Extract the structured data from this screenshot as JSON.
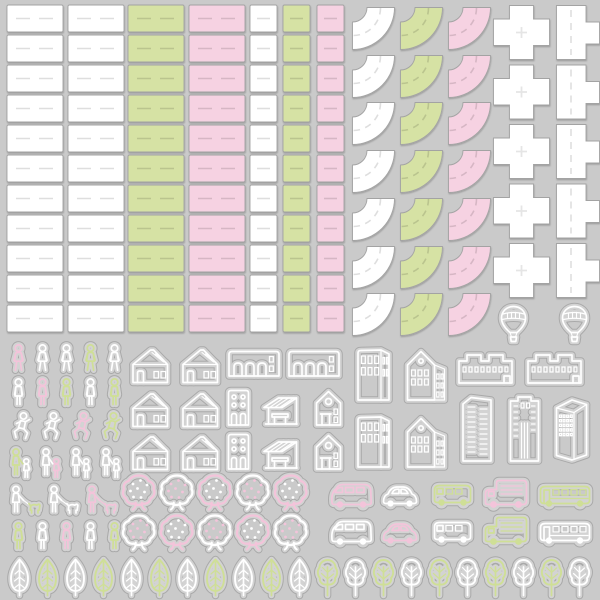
{
  "palette": {
    "background": "#cacaca",
    "tile_white": "#ffffff",
    "tile_green": "#d6e2a4",
    "tile_pink": "#f6d2e2",
    "tile_border": "#a3a3a3",
    "sticker_cut": "#a9a9a9",
    "sticker_halo": "#d3d3d3",
    "art_white": "#ffffff",
    "art_green": "#cfdf96",
    "art_pink": "#f3c4da"
  },
  "road_tiles": {
    "long_straight": {
      "rows": 11,
      "columns": [
        "white",
        "white",
        "green",
        "pink"
      ]
    },
    "square_straight": {
      "rows": 11,
      "columns": [
        "white",
        "green",
        "pink"
      ]
    },
    "curve": {
      "rows": 7,
      "columns": [
        "white",
        "green",
        "pink"
      ]
    },
    "cross_intersection": {
      "rows": 5,
      "color": "white"
    },
    "tee_intersection": {
      "rows": 5,
      "color": "white"
    }
  },
  "stickers": {
    "balloons": [
      "white",
      "white"
    ],
    "people": {
      "walking": [
        "pink",
        "white",
        "white",
        "green",
        "white"
      ],
      "standing_upper": [
        "white",
        "pink",
        "green",
        "white",
        "green"
      ],
      "running": [
        "white",
        "white",
        "pink",
        "green"
      ],
      "adult_child": [
        [
          "green",
          "white"
        ],
        [
          "white",
          "pink"
        ],
        [
          "white",
          "white"
        ],
        [
          "white",
          "white"
        ]
      ],
      "dog_walkers": [
        [
          "white",
          "green"
        ],
        [
          "white",
          "white"
        ],
        [
          "pink",
          "pink"
        ]
      ],
      "standing_lower": [
        "green",
        "white",
        "pink",
        "white",
        "green"
      ]
    },
    "buildings": {
      "house": [
        "white",
        "white",
        "white",
        "white",
        "white",
        "white"
      ],
      "arcade": [
        "white",
        "white"
      ],
      "narrow": [
        "white",
        "white"
      ],
      "awning_shop": [
        "white",
        "white"
      ],
      "chapel_small": [
        "white",
        "white"
      ],
      "tall_office": [
        "white",
        "white"
      ],
      "chapel": [
        "white",
        "white"
      ],
      "factory": [
        "white",
        "white"
      ],
      "skyscraper_a": [
        "white"
      ],
      "skyscraper_b": [
        "white"
      ],
      "skyscraper_c": [
        "white"
      ]
    },
    "fruit_trees": {
      "row1": [
        "pink",
        "white",
        "pink",
        "white",
        "pink"
      ],
      "row2": [
        "white",
        "pink",
        "white",
        "pink",
        "white"
      ]
    },
    "vehicles": {
      "row1": [
        {
          "type": "van",
          "color": "pink"
        },
        {
          "type": "car",
          "color": "white"
        },
        {
          "type": "minibus",
          "color": "green"
        },
        {
          "type": "truck",
          "color": "pink"
        },
        {
          "type": "bus",
          "color": "green"
        }
      ],
      "row2": [
        {
          "type": "van",
          "color": "white"
        },
        {
          "type": "car",
          "color": "pink"
        },
        {
          "type": "minibus",
          "color": "white"
        },
        {
          "type": "truck",
          "color": "green"
        },
        {
          "type": "bus",
          "color": "white"
        }
      ]
    },
    "bottom_trees": [
      {
        "style": "leaf",
        "color": "white"
      },
      {
        "style": "leaf",
        "color": "green"
      },
      {
        "style": "leaf",
        "color": "white"
      },
      {
        "style": "leaf",
        "color": "green"
      },
      {
        "style": "leaf",
        "color": "white"
      },
      {
        "style": "leaf",
        "color": "green"
      },
      {
        "style": "leaf",
        "color": "white"
      },
      {
        "style": "leaf",
        "color": "green"
      },
      {
        "style": "leaf",
        "color": "white"
      },
      {
        "style": "leaf",
        "color": "green"
      },
      {
        "style": "leaf",
        "color": "white"
      },
      {
        "style": "bushy",
        "color": "green"
      },
      {
        "style": "bushy",
        "color": "white"
      },
      {
        "style": "bushy",
        "color": "green"
      },
      {
        "style": "bushy",
        "color": "white"
      },
      {
        "style": "bushy",
        "color": "green"
      },
      {
        "style": "bushy",
        "color": "white"
      },
      {
        "style": "bushy",
        "color": "green"
      },
      {
        "style": "bushy",
        "color": "white"
      },
      {
        "style": "bushy",
        "color": "green"
      },
      {
        "style": "bushy",
        "color": "white"
      }
    ]
  }
}
